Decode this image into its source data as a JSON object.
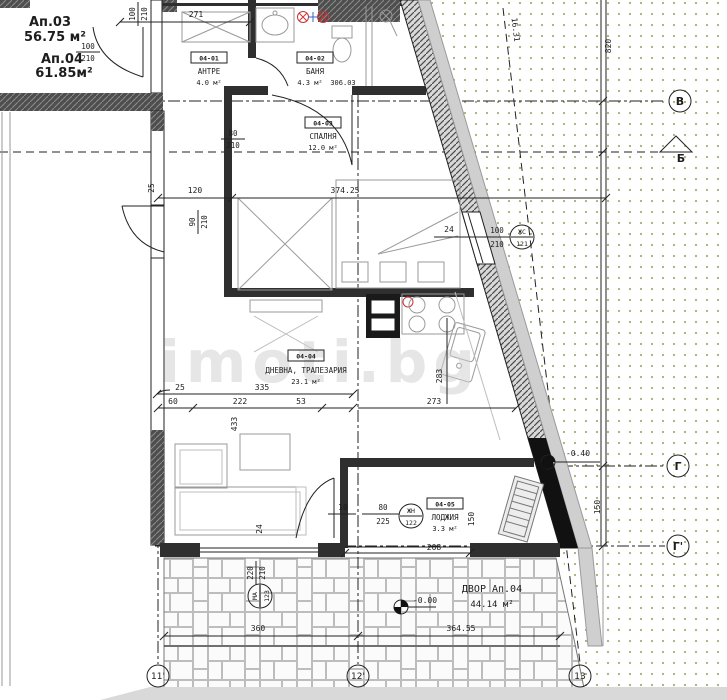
{
  "watermark": "imoti.bg",
  "labels": {
    "ap03": {
      "name": "Ап.03",
      "area": "56.75 м²"
    },
    "ap04": {
      "name": "Ап.04",
      "area": "61.85м²"
    }
  },
  "rooms": {
    "antre": {
      "tag": "04-01",
      "name": "АНТРЕ",
      "area": "4.0 м²"
    },
    "banya": {
      "tag": "04-02",
      "name": "БАНЯ",
      "area": "4.3 м²",
      "extra": "306.03"
    },
    "spalnya": {
      "tag": "04-03",
      "name": "СПАЛНЯ",
      "area": "12.0 м²"
    },
    "dnevna": {
      "tag": "04-04",
      "name": "ДНЕВНА, ТРАПЕЗАРИЯ",
      "area": "23.1 м²"
    },
    "lodzhiya": {
      "tag": "04-05",
      "name": "ЛОДЖИЯ",
      "area": "3.3 м²"
    },
    "dvor": {
      "name": "ДВОР Ап.04",
      "area": "44.14 м²"
    }
  },
  "dims": {
    "d271": "271",
    "d120": "120",
    "d37425": "374.25",
    "d25a": "25",
    "d25b": "25",
    "d335": "335",
    "d60": "60",
    "d222": "222",
    "d53": "53",
    "d273": "273",
    "d283": "283",
    "d433": "433",
    "d24a": "24",
    "d24b": "24",
    "d10": "10",
    "d208": "208",
    "d150a": "150",
    "d150b": "150",
    "d360": "360",
    "d36455": "364.55",
    "d820": "820",
    "d1631": "16.31"
  },
  "openings": {
    "entry": {
      "w": "100",
      "h": "210"
    },
    "topleft": {
      "w": "100",
      "h": "210"
    },
    "left": {
      "w": "90",
      "h": "210"
    },
    "bedroom": {
      "w": "80",
      "h": "210"
    },
    "window_e": {
      "w": "100",
      "h": "210"
    },
    "loggia": {
      "w": "80",
      "h": "225"
    },
    "yard": {
      "w": "220",
      "h": "210"
    }
  },
  "tags": {
    "zhs": {
      "line1": "ЖС",
      "line2": "121"
    },
    "zhn": {
      "line1": "ЖН",
      "line2": "122"
    },
    "ma": {
      "line1": "МА",
      "line2": "123"
    }
  },
  "levels": {
    "m040": "-0.40",
    "m000": "-0.00"
  },
  "axes": {
    "v": "В",
    "b": "Б",
    "g": "Г",
    "g_prime": "Г'",
    "a11": "11'",
    "a12": "12'",
    "a13": "13"
  },
  "colors": {
    "terrain_dots": "#a3b075",
    "walls": "#2f2f2f",
    "watermark_gray": "#cfcfcf",
    "hot_water_red": "#cc3333",
    "cold_water_blue": "#3366cc"
  }
}
